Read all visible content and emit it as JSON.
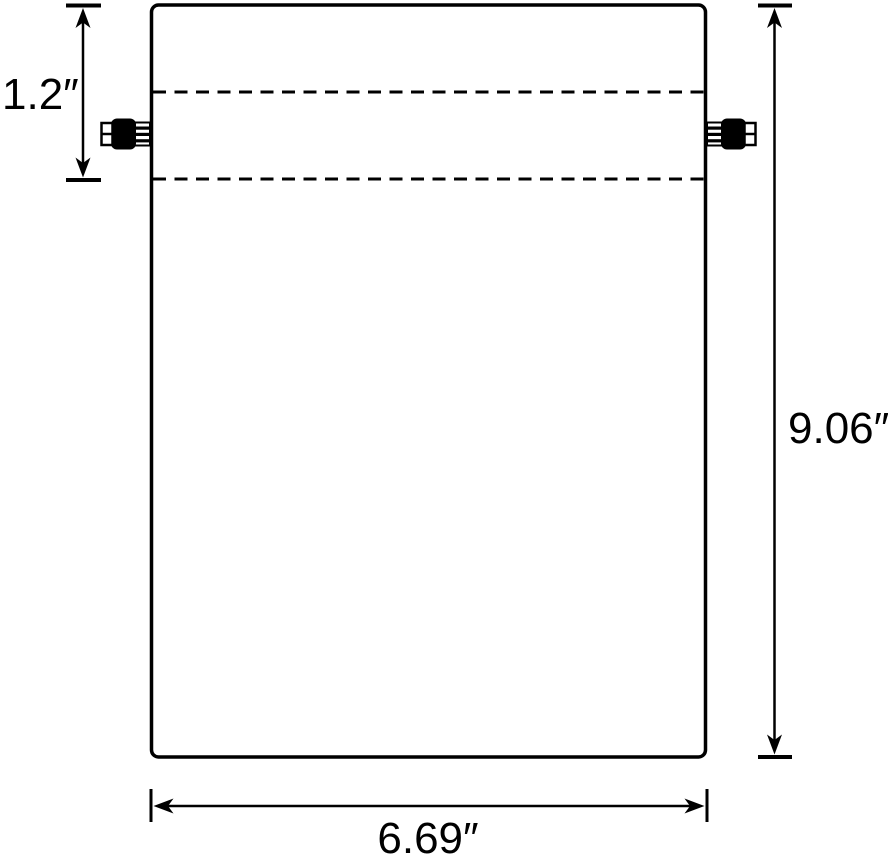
{
  "page": {
    "background": "#ffffff",
    "line_color": "#000000"
  },
  "diagram": {
    "kind": "drawstring-bag-dimension-diagram",
    "dimensions": {
      "channel_depth": {
        "label": "1.2″",
        "value": 1.2,
        "unit": "in"
      },
      "height": {
        "label": "9.06″",
        "value": 9.06,
        "unit": "in"
      },
      "width": {
        "label": "6.69″",
        "value": 6.69,
        "unit": "in"
      }
    }
  }
}
